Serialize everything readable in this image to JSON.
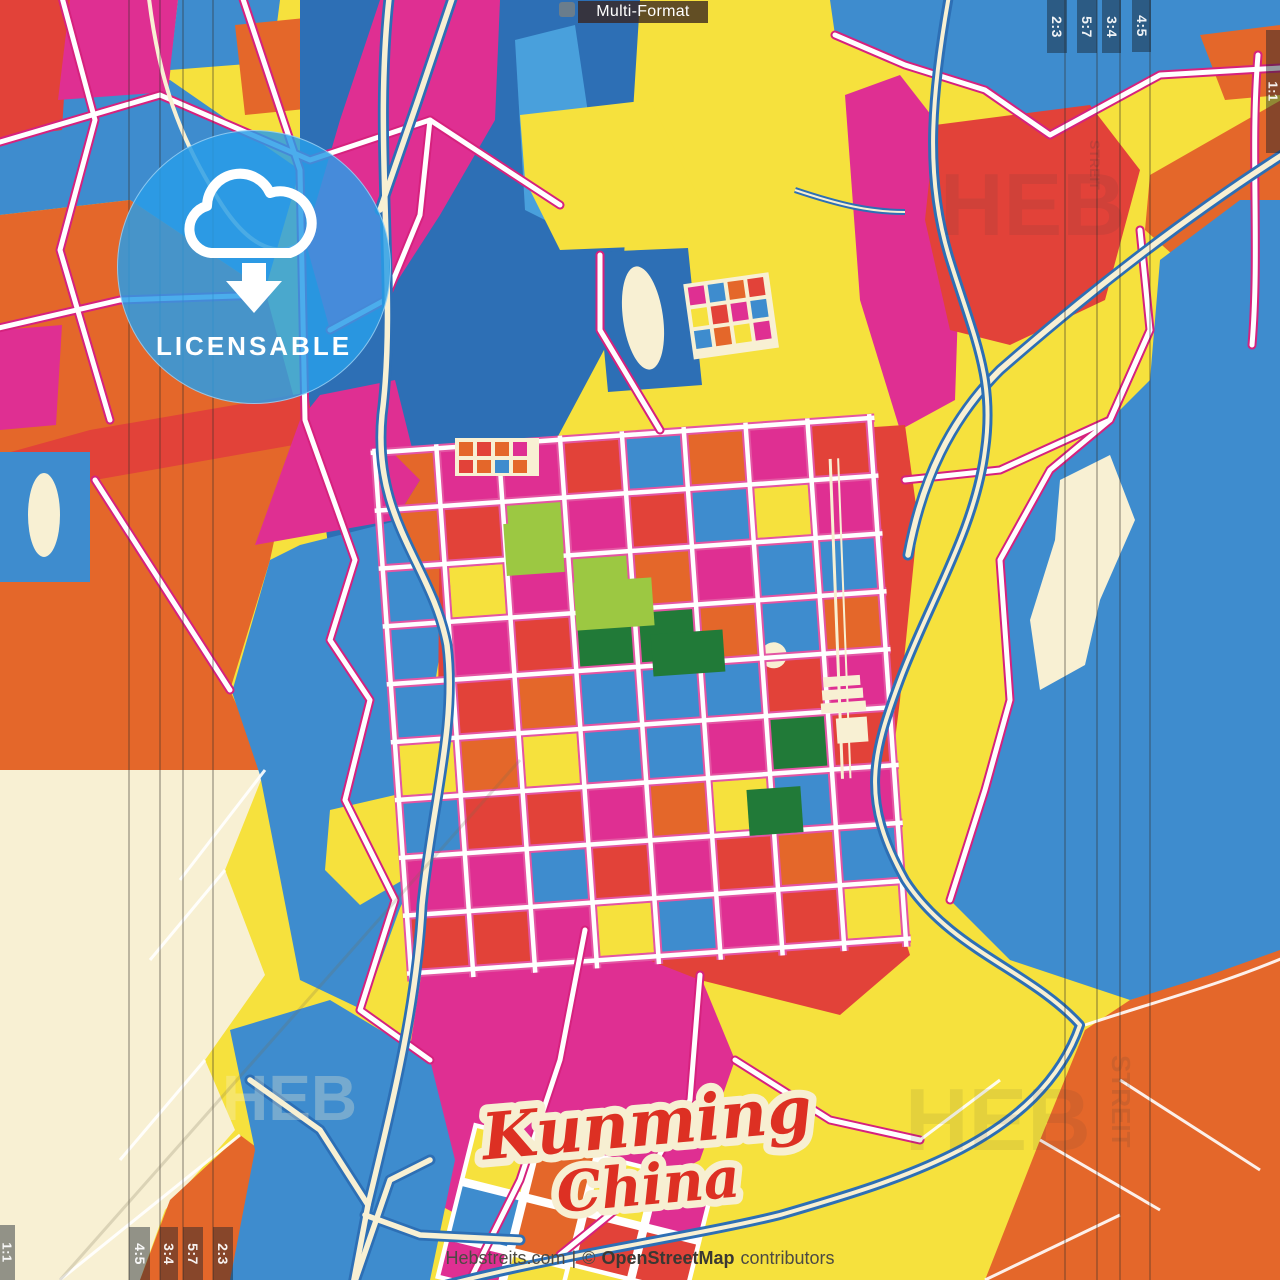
{
  "overlay": {
    "format_bar": "Multi-Format",
    "badge_label": "LICENSABLE",
    "formats_top_right": [
      "2:3",
      "5:7",
      "3:4",
      "4:5",
      "1:1"
    ],
    "formats_bottom_left": [
      "1:1",
      "4:5",
      "3:4",
      "5:7",
      "2:3"
    ]
  },
  "title": {
    "city": "Kunming",
    "country": "China"
  },
  "footer": {
    "site": "Hebstreits.com",
    "separator": "|",
    "copyright": "©",
    "osm": "OpenStreetMap",
    "contributors": "contributors"
  },
  "watermarks": {
    "brand": "HEB",
    "brand2": "STREIT"
  },
  "palette": {
    "yellow": "#F6E13D",
    "orange": "#E4672A",
    "red": "#E24239",
    "magenta": "#DF2F92",
    "blue": "#3E8CCE",
    "blue_dark": "#2D6FB5",
    "cream": "#F8F0D3",
    "green_light": "#9CC842",
    "green_dark": "#217A38",
    "road_casing": "#D6217E",
    "badge_blue": "#299DE8",
    "title_red": "#DD3023"
  }
}
